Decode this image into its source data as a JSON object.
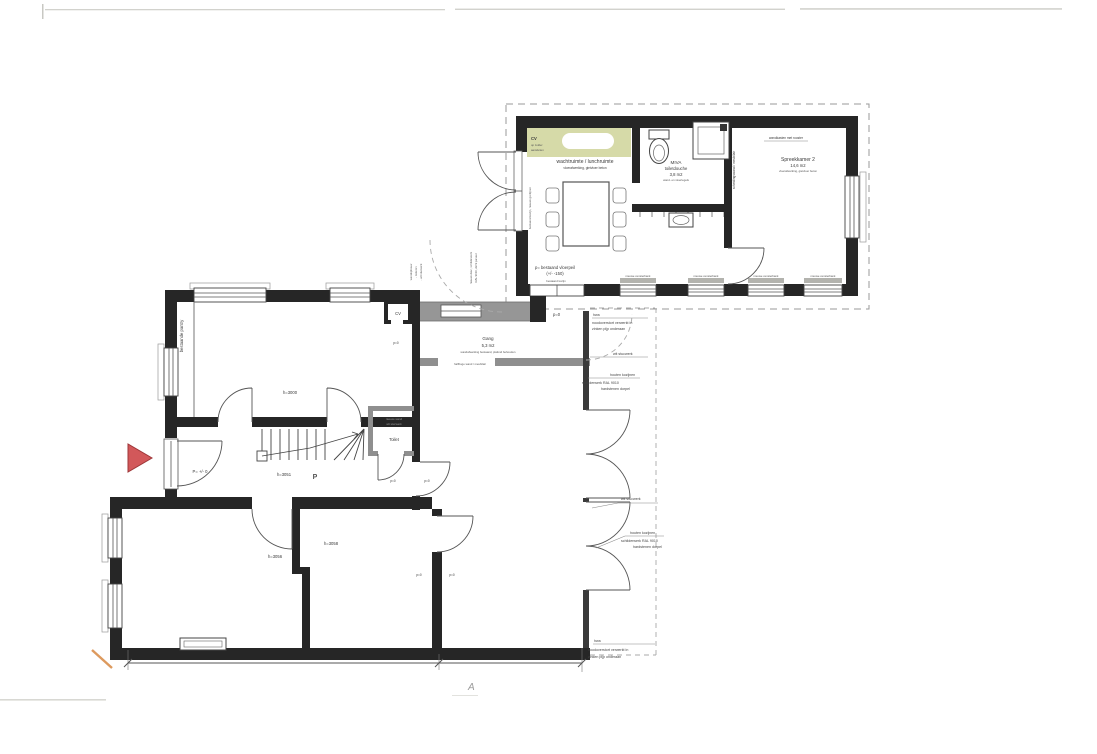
{
  "colors": {
    "wall": "#262626",
    "new_wall": "#8f8f8f",
    "accent_green": "#d6daa8",
    "arrow_red": "#d2585a"
  },
  "annex": {
    "cv_note": {
      "title": "CV",
      "line1": "op zolder",
      "line2": "aansluiten"
    },
    "waiting_room": {
      "name": "wachtruimte / lunchruimte",
      "spec": "vloerafwerking, gietvloer beton"
    },
    "miva_room": {
      "name": "MIVA",
      "subname": "toiletdouche",
      "area": "3,8 m2",
      "spec": "wand- en vloertegels"
    },
    "consult_room": {
      "name": "Spreekkamer 2",
      "area": "14,6 m2",
      "spec": "vloerafwerking, gietvloer beton"
    },
    "cabinet_note": "wandkasten met rooster",
    "partition_note": "scheidingswand / meubilair",
    "window_note": "bestaand kozijn, nieuwe gordijnen",
    "existing_frame_note": "bestaand kozijn",
    "floor_level_note": {
      "line1": "p= bestaand vloerpeil",
      "line2": "(+/- -150)"
    },
    "sill_note": "nieuwe vensterbank",
    "level_zero": "p=0"
  },
  "facade_notes": {
    "hwa": {
      "line1": "hwa",
      "line2": "noodoverstort verwerkt in",
      "line3": "zinken pijp onderaan"
    },
    "stucco": "wit stucwerk",
    "frames": {
      "line1": "houten kozijnen",
      "line2": "schilderwerk RAL 9010",
      "line3": "hardstenen dorpel"
    }
  },
  "link": {
    "wall_note": {
      "line1": "wandopbouw",
      "line2": "- isoleren",
      "line3": "- wit stucwerk"
    },
    "door_note": {
      "line1": "nieuwe deur, schilderwerk",
      "line2": "RAL 9010, dicht paneel"
    }
  },
  "main_house": {
    "pantry_note": "bestaande pantry",
    "height_3000": "h=3000",
    "cv_label": "CV",
    "gang": {
      "name": "Gang",
      "area": "5,3 m2",
      "spec": "wandafwerking bestaand, plafond behouden"
    },
    "low_wall_note": "halfhoge wand / meubilair",
    "toilet_label": "Toilet",
    "toilet_note": {
      "line1": "nieuwe wand",
      "line2": "wit stucwerk"
    },
    "height_3051": "h=3051",
    "stair_letter": "P",
    "entry_level": "P= +/- 0",
    "height_3056": "h=3056",
    "height_3058": "h=3058",
    "level_zero": "p=0"
  },
  "annotations": {
    "section_letter": "A"
  }
}
